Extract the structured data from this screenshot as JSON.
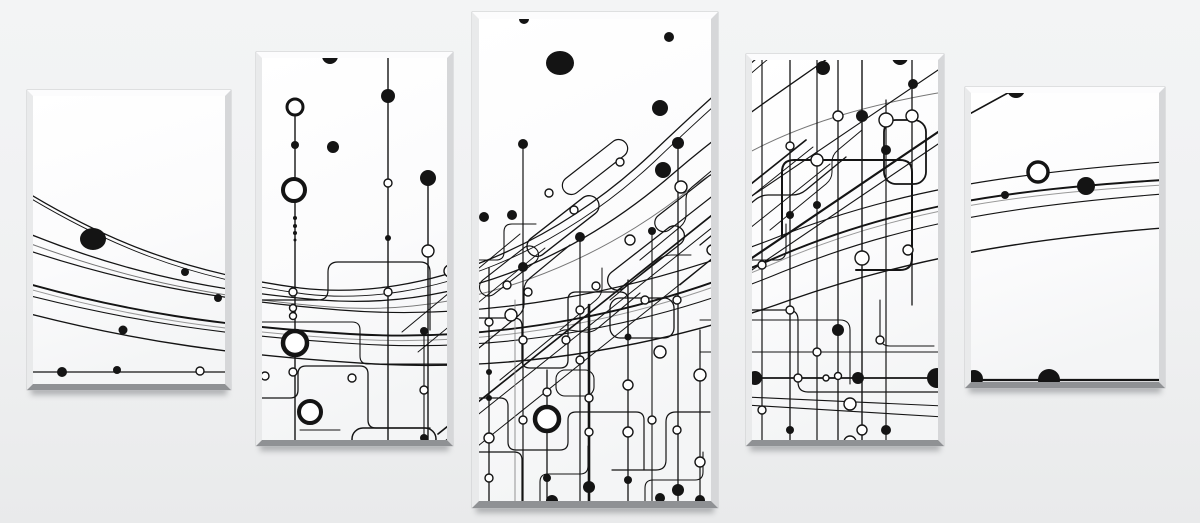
{
  "scene": {
    "subject": "five-part canvas print, abstract black and white circuit line artwork",
    "background_top": "#f3f4f5",
    "background_bottom": "#e9eaeb",
    "ink": "#141414",
    "width": 1200,
    "height": 523,
    "panel_count": 5
  },
  "panel_colors": {
    "face_top": "#ffffff",
    "face_bottom": "#f4f5f6",
    "bevel_top": "#fcfcfd",
    "bevel_left": "#e9eaeb",
    "bevel_right": "#d6d7d9",
    "bevel_bottom": "#8f9194",
    "outline": "#c0c1c3",
    "shadow": "#75777a"
  },
  "panels": [
    {
      "name": "canvas-panel-1",
      "x": 27,
      "y": 90,
      "w": 204,
      "h": 300,
      "b": 6
    },
    {
      "name": "canvas-panel-2",
      "x": 256,
      "y": 52,
      "w": 197,
      "h": 394,
      "b": 6
    },
    {
      "name": "canvas-panel-3",
      "x": 472,
      "y": 12,
      "w": 246,
      "h": 496,
      "b": 7
    },
    {
      "name": "canvas-panel-4",
      "x": 746,
      "y": 54,
      "w": 198,
      "h": 392,
      "b": 6
    },
    {
      "name": "canvas-panel-5",
      "x": 965,
      "y": 87,
      "w": 200,
      "h": 301,
      "b": 6
    }
  ],
  "artwork": {
    "sweeps": [
      {
        "d": "M 15 185 C 100 238 180 272 300 288 C 430 303 560 240 650 155 C 720 88 760 55 815 10",
        "w": 1.3
      },
      {
        "d": "M 20 192 C 105 244 185 278 305 294 C 435 309 565 246 655 161 C 725 94 765 61 820 16",
        "w": 0.9
      },
      {
        "d": "M 15 228 C 110 268 200 290 320 300 C 460 311 580 255 675 172 C 745 112 800 80 870 28",
        "w": 1.3
      },
      {
        "d": "M 15 238 C 115 276 205 297 330 307 C 470 318 600 262 695 185 C 790 120 880 98 1040 78",
        "w": 1.0,
        "c": "#777777"
      },
      {
        "d": "M 15 246 C 120 282 215 300 340 310 C 490 322 640 290 770 240 C 890 192 1000 174 1163 162",
        "w": 1.2
      },
      {
        "d": "M 15 280 C 125 312 220 326 350 334 C 500 343 650 312 775 258 C 895 206 1005 190 1163 180",
        "w": 1.9
      },
      {
        "d": "M 15 285 C 125 317 220 331 350 339 C 500 348 650 317 775 263 C 895 211 1005 195 1163 185",
        "w": 1.0,
        "c": "#999999"
      },
      {
        "d": "M 15 292 C 130 322 230 336 360 344 C 510 353 655 325 782 272 C 900 224 1010 206 1163 194",
        "w": 1.1
      },
      {
        "d": "M 15 310 C 135 342 240 356 375 364 C 525 372 668 344 790 300 C 905 260 1015 240 1163 228",
        "w": 1.4
      }
    ],
    "lines": [
      [
        15,
        372,
        240,
        372,
        1.2
      ],
      [
        746,
        378,
        944,
        378,
        1.7
      ],
      [
        746,
        397,
        944,
        406,
        1.1
      ],
      [
        746,
        405,
        944,
        417,
        1.1
      ],
      [
        962,
        380,
        1168,
        380,
        2.2
      ],
      [
        944,
        128,
        1066,
        61,
        1.6
      ],
      [
        438,
        434,
        806,
        140,
        1.7
      ],
      [
        445,
        441,
        813,
        147,
        1.0
      ],
      [
        448,
        470,
        830,
        164,
        1.0
      ],
      [
        746,
        262,
        944,
        128,
        2.2
      ],
      [
        746,
        274,
        944,
        140,
        1.1
      ],
      [
        746,
        200,
        944,
        66,
        1.1
      ],
      [
        680,
        285,
        740,
        236,
        1.0
      ],
      [
        300,
        430,
        340,
        430,
        1.0
      ],
      [
        700,
        352,
        944,
        352,
        1.1
      ],
      [
        402,
        332,
        520,
        234,
        1.0
      ],
      [
        418,
        352,
        545,
        248,
        0.9
      ]
    ],
    "verticals": [
      [
        295,
        100,
        446,
        1.4
      ],
      [
        388,
        53,
        446,
        1.4
      ],
      [
        428,
        178,
        446,
        1.4
      ],
      [
        424,
        331,
        446,
        1.1
      ],
      [
        489,
        268,
        502,
        1.3
      ],
      [
        515,
        300,
        502,
        0.9,
        "#888888"
      ],
      [
        523,
        144,
        502,
        1.2
      ],
      [
        547,
        370,
        502,
        1.3
      ],
      [
        580,
        237,
        502,
        1.2
      ],
      [
        589,
        305,
        502,
        2.6
      ],
      [
        628,
        280,
        502,
        1.3
      ],
      [
        652,
        231,
        502,
        1.1
      ],
      [
        678,
        143,
        502,
        1.3
      ],
      [
        700,
        330,
        502,
        1.2
      ],
      [
        762,
        60,
        440,
        1.2
      ],
      [
        790,
        60,
        440,
        1.3
      ],
      [
        817,
        60,
        440,
        1.2
      ],
      [
        838,
        60,
        440,
        1.3
      ],
      [
        862,
        60,
        440,
        1.4
      ],
      [
        886,
        100,
        440,
        1.2
      ],
      [
        912,
        60,
        305,
        1.3
      ]
    ],
    "traces": [
      {
        "d": "M 262 300 H 318 Q 328 300 328 290 V 272 Q 328 262 338 262 H 420 Q 430 262 430 272 V 330",
        "w": 1.2
      },
      {
        "d": "M 262 322 H 352 Q 360 322 360 330 V 356 Q 360 364 368 364 H 447",
        "w": 1.1
      },
      {
        "d": "M 262 398 H 290 Q 298 398 298 390 V 374 Q 298 366 306 366 H 360 Q 368 366 368 374 V 420 Q 368 428 376 428 H 430",
        "w": 1.3
      },
      {
        "d": "M 478 318 H 514 Q 522 318 522 326 V 360 Q 522 368 530 368 H 560 Q 568 368 568 360 V 300 Q 568 292 576 292 H 620 Q 628 292 628 300 V 340",
        "w": 1.3
      },
      {
        "d": "M 478 398 H 500 Q 508 398 508 406 V 442 Q 508 450 516 450 H 560 Q 568 450 568 442 V 420 Q 568 412 576 412 H 636 Q 644 412 644 420 V 470",
        "w": 1.2
      },
      {
        "d": "M 478 452 H 514 Q 522 452 522 460 V 502",
        "w": 1.2
      },
      {
        "d": "M 540 502 V 482 Q 540 474 548 474 H 580 Q 588 474 588 466 V 446",
        "w": 1.1
      },
      {
        "d": "M 612 470 H 656 Q 666 470 666 460 V 422 Q 666 412 676 412 H 710",
        "w": 1.2
      },
      {
        "d": "M 700 320 H 840 Q 850 320 850 330 V 384",
        "w": 1.1
      },
      {
        "d": "M 645 502 V 488 Q 645 480 653 480 H 695 Q 703 480 703 472 V 452",
        "w": 1.1
      },
      {
        "d": "M 782 237 V 172 Q 782 160 794 160 H 900 Q 912 160 912 172 V 258 Q 912 270 900 270 H 856",
        "w": 2.0
      },
      {
        "d": "M 752 310 H 788 Q 798 310 798 320 V 382 Q 798 392 808 392 H 944",
        "w": 1.2
      },
      {
        "d": "M 880 300 V 336 Q 880 346 890 346 H 934",
        "w": 1.1
      },
      {
        "d": "M 752 260 H 776 Q 786 260 786 250 V 224",
        "w": 1.1
      },
      {
        "d": "M 474 352 L 518 316 Q 524 311 524 304 V 290 Q 524 283 530 278 L 570 245",
        "w": 1.2
      },
      {
        "d": "M 500 380 L 556 334 Q 562 329 569 330 L 585 332 Q 592 333 598 328 L 640 293",
        "w": 1.1
      },
      {
        "d": "M 560 330 L 596 300 Q 602 295 602 288 V 268",
        "w": 1.0
      },
      {
        "d": "M 610 300 L 658 260 Q 664 255 671 255 H 691",
        "w": 1.0
      },
      {
        "d": "M 640 260 L 680 227 Q 686 222 686 215 V 199 Q 686 192 692 187 L 722 162",
        "w": 1.1
      },
      {
        "d": "M 700 245 L 755 200 Q 761 195 768 195 H 792 Q 800 195 806 190 L 846 157",
        "w": 1.3
      },
      {
        "d": "M 770 230 L 826 184 Q 832 179 832 172 V 162 Q 832 155 838 150 L 862 130",
        "w": 1.0
      },
      {
        "d": "M 478 260 H 496 Q 504 260 504 252 V 232 Q 504 224 512 224 H 536",
        "w": 1.1
      }
    ],
    "capsules": [
      [
        520,
        216,
        86,
        20,
        10,
        -38,
        1.3
      ],
      [
        556,
        158,
        78,
        18,
        9,
        -38,
        1.2
      ],
      [
        600,
        248,
        92,
        20,
        10,
        -38,
        1.3
      ],
      [
        474,
        262,
        70,
        18,
        9,
        -38,
        1.1
      ],
      [
        648,
        194,
        82,
        18,
        9,
        -38,
        1.2
      ],
      [
        352,
        428,
        84,
        22,
        11,
        0,
        1.5
      ],
      [
        610,
        298,
        64,
        40,
        10,
        0,
        1.3
      ],
      [
        556,
        370,
        38,
        26,
        9,
        0,
        1.1
      ],
      [
        884,
        120,
        42,
        64,
        12,
        0,
        1.8
      ]
    ],
    "rings": [
      [
        295,
        107,
        8,
        3
      ],
      [
        294,
        190,
        11,
        4
      ],
      [
        295,
        343,
        12,
        4.5
      ],
      [
        310,
        412,
        11,
        4
      ],
      [
        547,
        419,
        12,
        4.5
      ],
      [
        1038,
        172,
        10,
        3.5
      ]
    ],
    "nodes": [
      [
        200,
        371,
        4
      ],
      [
        388,
        183,
        4
      ],
      [
        428,
        251,
        6
      ],
      [
        293,
        292,
        4
      ],
      [
        293,
        308,
        3.5
      ],
      [
        293,
        316,
        3.5
      ],
      [
        293,
        372,
        4
      ],
      [
        265,
        376,
        4
      ],
      [
        352,
        378,
        4
      ],
      [
        424,
        390,
        4
      ],
      [
        450,
        271,
        6
      ],
      [
        388,
        292,
        4
      ],
      [
        549,
        193,
        4
      ],
      [
        681,
        187,
        6
      ],
      [
        507,
        285,
        4
      ],
      [
        489,
        322,
        4
      ],
      [
        489,
        438,
        5
      ],
      [
        489,
        478,
        4
      ],
      [
        528,
        292,
        4
      ],
      [
        547,
        392,
        4
      ],
      [
        566,
        340,
        4
      ],
      [
        589,
        398,
        4
      ],
      [
        589,
        432,
        4
      ],
      [
        628,
        385,
        5
      ],
      [
        660,
        352,
        6
      ],
      [
        677,
        300,
        4
      ],
      [
        700,
        375,
        6
      ],
      [
        700,
        462,
        5
      ],
      [
        712,
        250,
        5
      ],
      [
        630,
        240,
        5
      ],
      [
        596,
        286,
        4
      ],
      [
        511,
        315,
        6
      ],
      [
        620,
        162,
        4
      ],
      [
        574,
        210,
        4
      ],
      [
        523,
        340,
        4
      ],
      [
        523,
        420,
        4
      ],
      [
        580,
        310,
        4
      ],
      [
        580,
        360,
        4
      ],
      [
        628,
        432,
        5
      ],
      [
        652,
        420,
        4
      ],
      [
        677,
        430,
        4
      ],
      [
        645,
        300,
        4
      ],
      [
        762,
        265,
        4
      ],
      [
        762,
        410,
        4
      ],
      [
        790,
        146,
        4
      ],
      [
        817,
        160,
        6
      ],
      [
        817,
        352,
        4
      ],
      [
        838,
        376,
        3.5
      ],
      [
        862,
        258,
        7
      ],
      [
        862,
        430,
        5
      ],
      [
        886,
        120,
        7
      ],
      [
        912,
        116,
        6
      ],
      [
        798,
        378,
        4
      ],
      [
        826,
        378,
        3
      ],
      [
        850,
        404,
        6
      ],
      [
        880,
        340,
        4
      ],
      [
        908,
        250,
        5
      ],
      [
        838,
        116,
        5
      ],
      [
        790,
        310,
        4
      ],
      [
        850,
        442,
        6
      ]
    ],
    "dots": [
      [
        93,
        239,
        13,
        11
      ],
      [
        185,
        272,
        4
      ],
      [
        218,
        298,
        4
      ],
      [
        123,
        330,
        4.5
      ],
      [
        62,
        372,
        5
      ],
      [
        117,
        370,
        4
      ],
      [
        330,
        56,
        8
      ],
      [
        333,
        147,
        6
      ],
      [
        388,
        96,
        7
      ],
      [
        388,
        238,
        3
      ],
      [
        428,
        178,
        8
      ],
      [
        295,
        145,
        4
      ],
      [
        295,
        218,
        2
      ],
      [
        295,
        226,
        2
      ],
      [
        295,
        233,
        2
      ],
      [
        295,
        240,
        1.5
      ],
      [
        424,
        331,
        4
      ],
      [
        424,
        438,
        4
      ],
      [
        443,
        444,
        4
      ],
      [
        560,
        63,
        14,
        12
      ],
      [
        669,
        37,
        5
      ],
      [
        524,
        19,
        5
      ],
      [
        660,
        108,
        8
      ],
      [
        678,
        143,
        6
      ],
      [
        663,
        170,
        8
      ],
      [
        523,
        144,
        5
      ],
      [
        512,
        215,
        5
      ],
      [
        484,
        217,
        5
      ],
      [
        580,
        237,
        5
      ],
      [
        652,
        231,
        4
      ],
      [
        523,
        267,
        5
      ],
      [
        628,
        337,
        3.5
      ],
      [
        589,
        487,
        6
      ],
      [
        660,
        498,
        5
      ],
      [
        678,
        490,
        6
      ],
      [
        547,
        478,
        4
      ],
      [
        489,
        372,
        3
      ],
      [
        489,
        398,
        3
      ],
      [
        628,
        480,
        4
      ],
      [
        700,
        500,
        5
      ],
      [
        552,
        501,
        6
      ],
      [
        823,
        68,
        7
      ],
      [
        900,
        57,
        8
      ],
      [
        913,
        84,
        5
      ],
      [
        862,
        116,
        6
      ],
      [
        817,
        205,
        4
      ],
      [
        838,
        330,
        6
      ],
      [
        755,
        378,
        7
      ],
      [
        858,
        378,
        6
      ],
      [
        937,
        378,
        10
      ],
      [
        886,
        150,
        5
      ],
      [
        790,
        215,
        4
      ],
      [
        790,
        430,
        4
      ],
      [
        886,
        430,
        5
      ],
      [
        1016,
        89,
        9
      ],
      [
        1005,
        195,
        4
      ],
      [
        1086,
        186,
        9
      ],
      [
        974,
        379,
        9
      ],
      [
        1049,
        380,
        11
      ]
    ]
  }
}
